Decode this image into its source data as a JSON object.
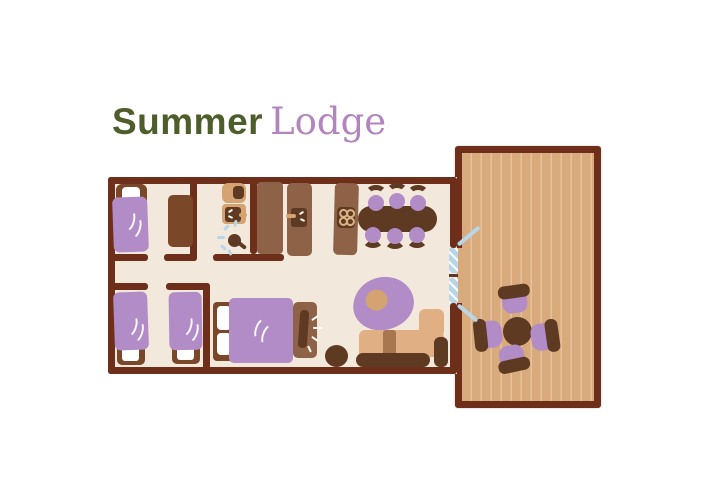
{
  "title": {
    "word1": "Summer",
    "word2": "Lodge"
  },
  "palette": {
    "wall": "#6d2e1a",
    "floor": "#f2e9dc",
    "dark": "#5d3a21",
    "mid": "#8e6247",
    "frame": "#7a4728",
    "tan": "#d5a271",
    "tanlight": "#e0b084",
    "strap": "#a8764f",
    "deck": "#d9aa7b",
    "deckline": "#e6c29c",
    "purple": "#b18cc6",
    "blue": "#b9d6e8",
    "titlegreen": "#4e5e2b",
    "titlelilac": "#b385bf",
    "white": "#ffffff"
  },
  "floorplan": {
    "areas": [
      "bedroom-top-left",
      "bathroom",
      "built-in-closet",
      "kitchen",
      "dining-area",
      "bedroom-bottom-left",
      "double-bedroom",
      "living-area",
      "deck-terrace"
    ],
    "furniture": [
      {
        "name": "single-bed",
        "count": 3
      },
      {
        "name": "double-bed",
        "count": 1
      },
      {
        "name": "wardrobe",
        "count": 1
      },
      {
        "name": "toilet",
        "count": 1
      },
      {
        "name": "washbasin",
        "count": 1
      },
      {
        "name": "shower",
        "count": 1
      },
      {
        "name": "tall-cabinet",
        "count": 1
      },
      {
        "name": "kitchen-sink-counter",
        "count": 1
      },
      {
        "name": "stove-counter",
        "count": 1
      },
      {
        "name": "dining-table",
        "count": 1
      },
      {
        "name": "dining-chair",
        "count": 6
      },
      {
        "name": "round-armchair",
        "count": 1
      },
      {
        "name": "floor-pouf",
        "count": 1
      },
      {
        "name": "nightstand-lamp",
        "count": 1
      },
      {
        "name": "sofa",
        "count": 1
      },
      {
        "name": "french-door",
        "count": 1
      },
      {
        "name": "patio-table",
        "count": 1
      },
      {
        "name": "patio-chair",
        "count": 4
      }
    ]
  }
}
